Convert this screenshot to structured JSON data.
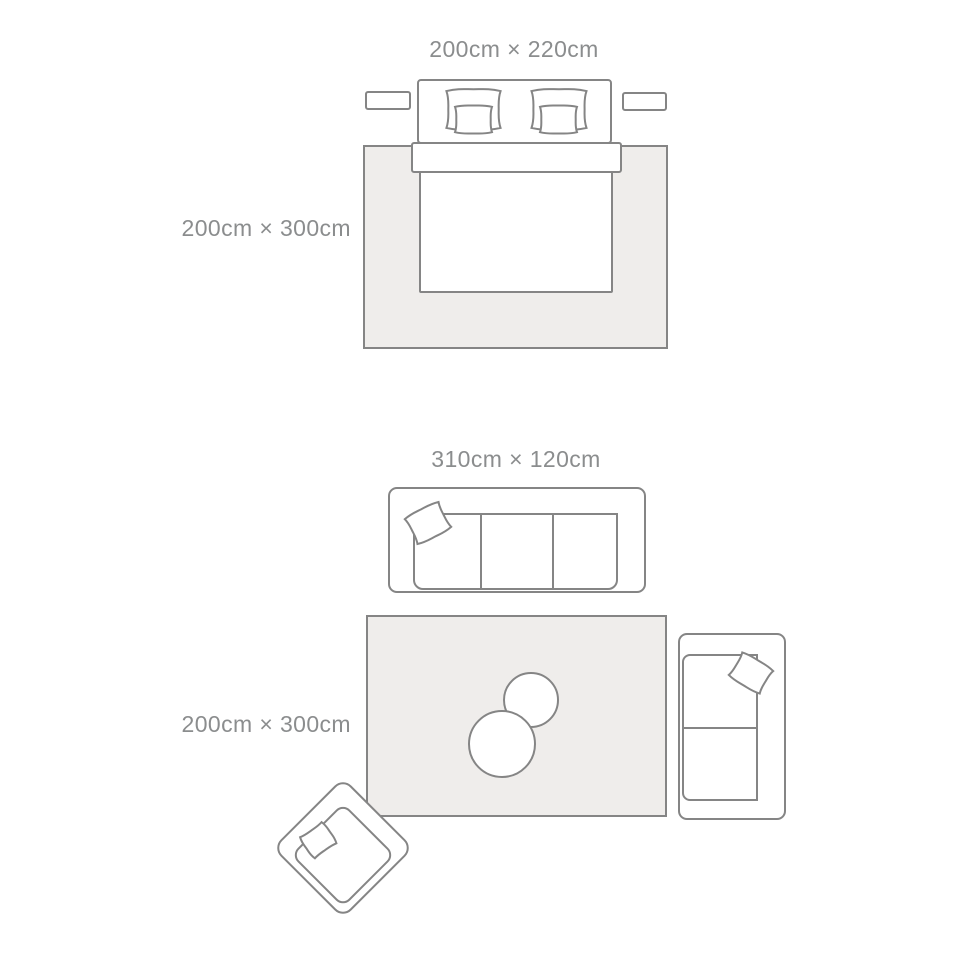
{
  "colors": {
    "outline": "#858585",
    "rug_fill": "#efedeb",
    "furniture_fill": "#ffffff",
    "label_color": "#8b8d8e",
    "page_bg": "#ffffff"
  },
  "bedroom": {
    "bed_label": "200cm × 220cm",
    "rug_label": "200cm × 300cm"
  },
  "living_room": {
    "sofa_label": "310cm × 120cm",
    "rug_label": "200cm × 300cm"
  }
}
